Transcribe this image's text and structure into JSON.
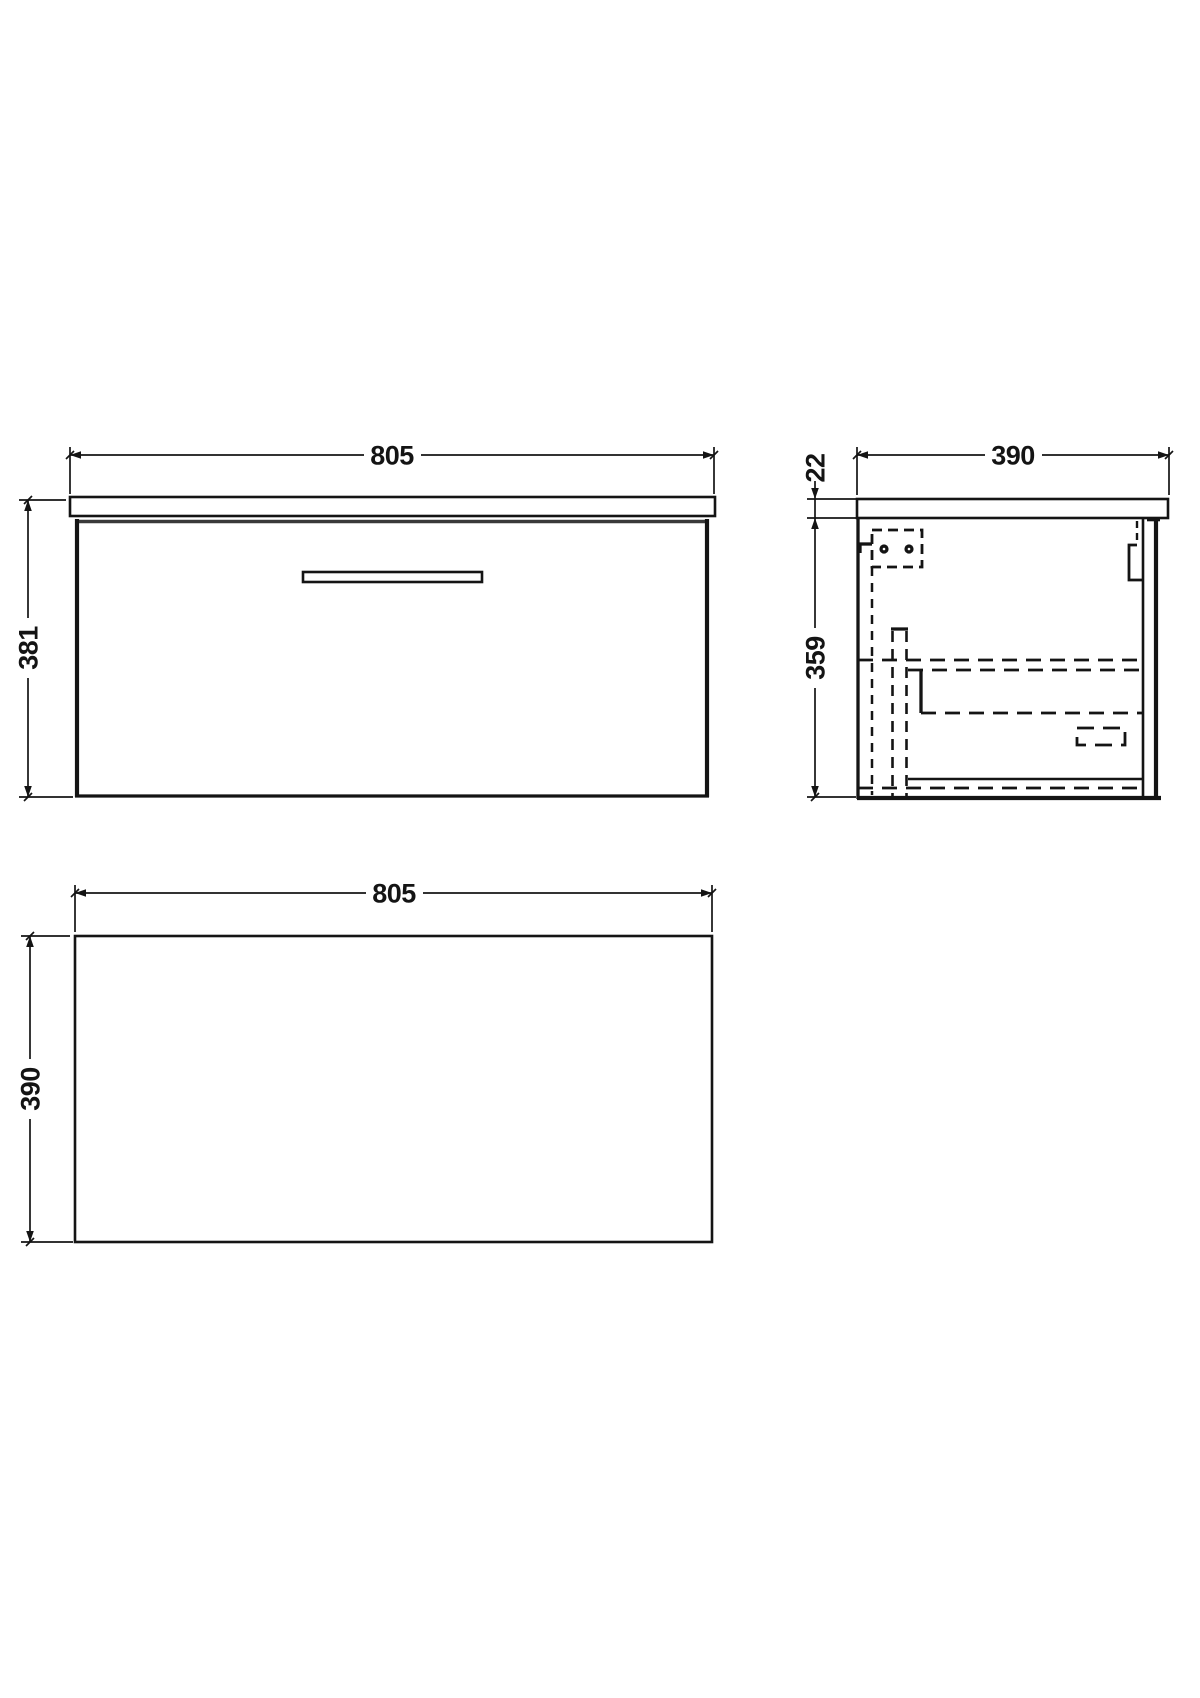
{
  "colors": {
    "background": "#ffffff",
    "line": "#141414"
  },
  "views": {
    "front": {
      "width": "805",
      "height": "381"
    },
    "side": {
      "depth": "390",
      "worktop_thickness": "22",
      "cabinet_height": "359"
    },
    "plan": {
      "width": "805",
      "depth": "390"
    }
  }
}
